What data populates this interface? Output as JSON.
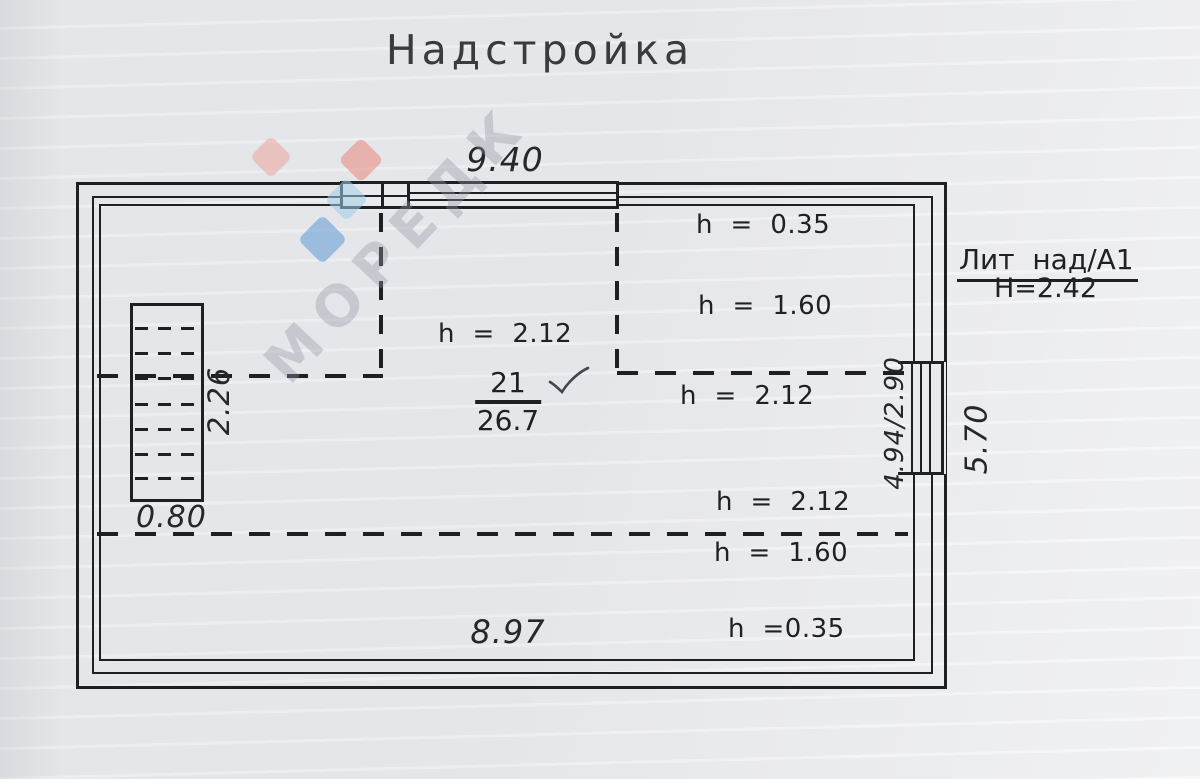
{
  "title": "Надстройка",
  "dimensions": {
    "top_width": "9.40",
    "bottom_width": "8.97",
    "stair_width": "0.80",
    "stair_depth": "2.26",
    "right_window": "4.94/2.90",
    "right_side": "5.70"
  },
  "heights": {
    "top_far": "h  =  0.35",
    "top_mid": "h  =  1.60",
    "center": "h  =  2.12",
    "mid_right": "h  =  2.12",
    "lower_upper": "h  =  2.12",
    "lower_below": "h  =  1.60",
    "bottom_far": "h  =0.35"
  },
  "room": {
    "number": "21",
    "area": "26.7"
  },
  "annotation": {
    "liter": "Лит  над/А1",
    "total_height": "Н=2.42"
  },
  "watermark": {
    "text": "МОРЕДК",
    "gray": "#9499a4",
    "salmon": "#eca094",
    "red": "#e97e73",
    "cyan": "#a0cde6",
    "blue": "#5f9bd2"
  },
  "colors": {
    "line": "#1f2024",
    "paper": "#e9eaed"
  }
}
